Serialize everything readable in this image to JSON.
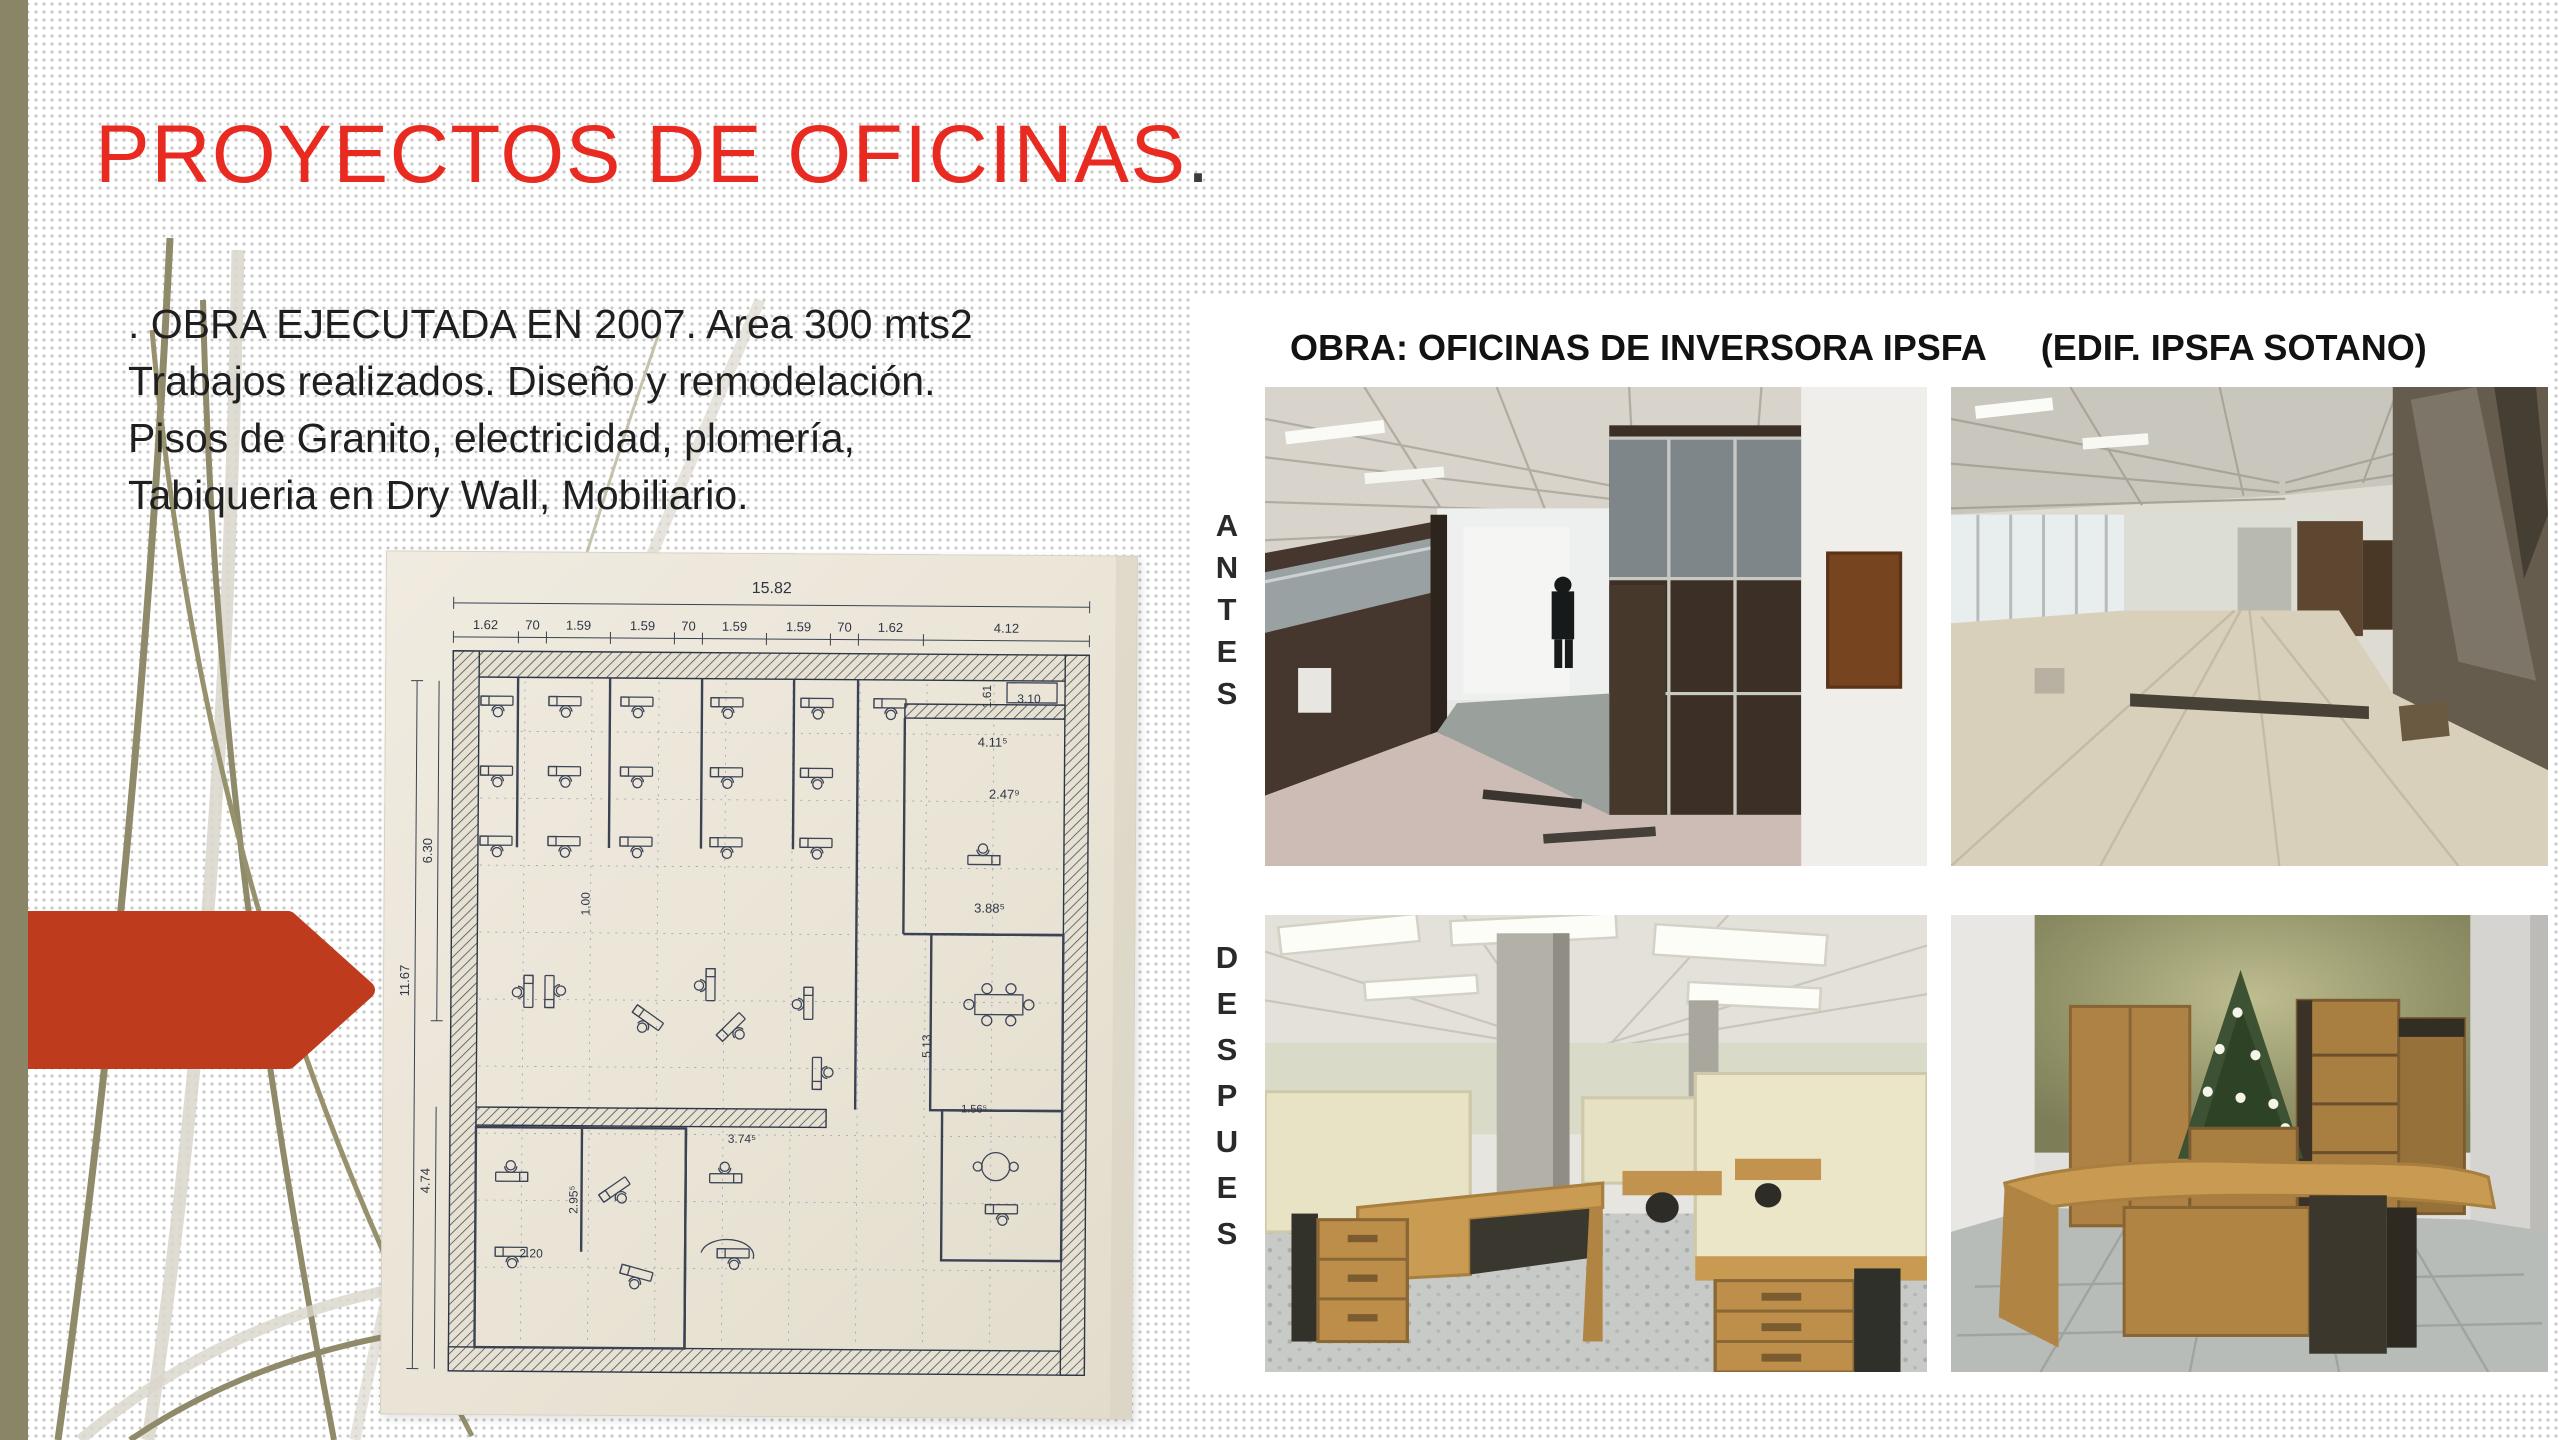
{
  "title": {
    "text": "PROYECTOS DE OFICINAS",
    "period": "."
  },
  "intro": {
    "lines": [
      ". OBRA EJECUTADA EN 2007. Area 300 mts2",
      "Trabajos realizados. Diseño y remodelación.",
      "Pisos de Granito, electricidad, plomería,",
      "Tabiqueria en Dry Wall, Mobiliario."
    ]
  },
  "project_panel": {
    "heading_obra": "OBRA: OFICINAS DE INVERSORA IPSFA",
    "heading_edif": "(EDIF. IPSFA SOTANO)",
    "row_labels": {
      "before": "ANTES",
      "after": "DESPUES"
    },
    "photos": [
      {
        "name": "antes-construction-partitions"
      },
      {
        "name": "antes-empty-hall"
      },
      {
        "name": "despues-cubicles-workstations"
      },
      {
        "name": "despues-executive-office-christmas-tree"
      }
    ]
  },
  "floor_plan": {
    "labels": [
      {
        "t": "15.82",
        "x": 386,
        "y": 40,
        "r": 0,
        "s": 16
      },
      {
        "t": "1.62",
        "x": 100,
        "y": 78,
        "r": 0,
        "s": 13
      },
      {
        "t": "70",
        "x": 147,
        "y": 78,
        "r": 0,
        "s": 13
      },
      {
        "t": "1.59",
        "x": 193,
        "y": 78,
        "r": 0,
        "s": 13
      },
      {
        "t": "1.59",
        "x": 257,
        "y": 78,
        "r": 0,
        "s": 13
      },
      {
        "t": "70",
        "x": 303,
        "y": 78,
        "r": 0,
        "s": 13
      },
      {
        "t": "1.59",
        "x": 349,
        "y": 78,
        "r": 0,
        "s": 13
      },
      {
        "t": "1.59",
        "x": 413,
        "y": 78,
        "r": 0,
        "s": 13
      },
      {
        "t": "70",
        "x": 459,
        "y": 78,
        "r": 0,
        "s": 13
      },
      {
        "t": "1.62",
        "x": 505,
        "y": 78,
        "r": 0,
        "s": 13
      },
      {
        "t": "4.12",
        "x": 621,
        "y": 78,
        "r": 0,
        "s": 13
      },
      {
        "t": "6.30",
        "x": 48,
        "y": 300,
        "r": -90,
        "s": 13
      },
      {
        "t": "11.67",
        "x": 26,
        "y": 430,
        "r": -90,
        "s": 13
      },
      {
        "t": "4.74",
        "x": 48,
        "y": 630,
        "r": -90,
        "s": 13
      },
      {
        "t": "1.00",
        "x": 206,
        "y": 352,
        "r": -90,
        "s": 12
      },
      {
        "t": "2.95⁵",
        "x": 196,
        "y": 648,
        "r": -90,
        "s": 12
      },
      {
        "t": "2.20",
        "x": 150,
        "y": 706,
        "r": 0,
        "s": 12
      },
      {
        "t": "1.61",
        "x": 606,
        "y": 142,
        "r": -90,
        "s": 12
      },
      {
        "t": "3.10",
        "x": 644,
        "y": 148,
        "r": 0,
        "s": 12
      },
      {
        "t": "4.11⁵",
        "x": 608,
        "y": 192,
        "r": 0,
        "s": 13
      },
      {
        "t": "2.47⁹",
        "x": 620,
        "y": 244,
        "r": 0,
        "s": 13
      },
      {
        "t": "3.88⁵",
        "x": 606,
        "y": 358,
        "r": 0,
        "s": 13
      },
      {
        "t": "5.13",
        "x": 548,
        "y": 492,
        "r": -90,
        "s": 12
      },
      {
        "t": "3.74⁵",
        "x": 360,
        "y": 590,
        "r": 0,
        "s": 12
      },
      {
        "t": "1.56⁵",
        "x": 592,
        "y": 558,
        "r": 0,
        "s": 11
      }
    ]
  },
  "colors": {
    "accent_red": "#e82a20",
    "arrow_red": "#bf3b1d",
    "olive_bar": "#8b8568",
    "plan_ink": "#3a4254",
    "plan_paper": "#eae4d6",
    "title_period": "#3c3c3c"
  }
}
